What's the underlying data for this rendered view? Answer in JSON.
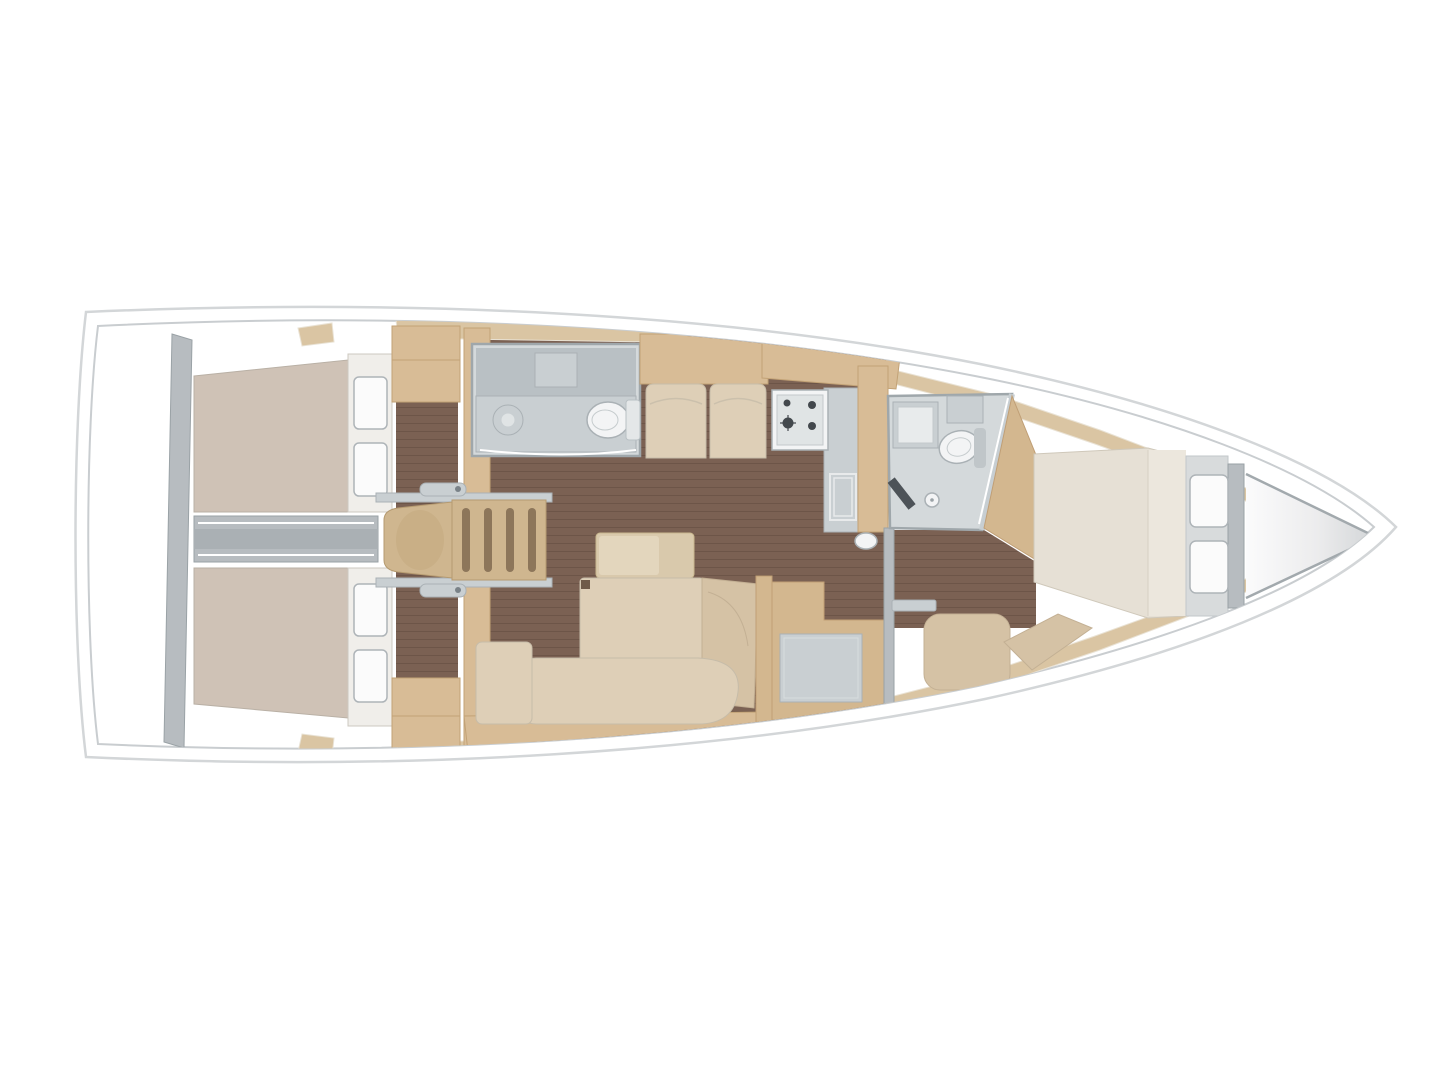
{
  "diagram": {
    "type": "sailboat-interior-floor-plan",
    "view": "top-down",
    "orientation": "bow-right",
    "features": [
      {
        "id": "hull-outline",
        "label": "sailboat hull with double deck line"
      },
      {
        "id": "transom-platform",
        "label": "stern platform"
      },
      {
        "id": "aft-cabin-port",
        "label": "aft double cabin port with berth and two pillows"
      },
      {
        "id": "aft-cabin-starboard",
        "label": "aft double cabin starboard with berth and two pillows"
      },
      {
        "id": "engine-box",
        "label": "engine compartment between aft cabins"
      },
      {
        "id": "companionway-stairs",
        "label": "companionway steps with four treads"
      },
      {
        "id": "head-aft",
        "label": "aft head with round washbasin and toilet"
      },
      {
        "id": "settee",
        "label": "two seat settee facing salon table"
      },
      {
        "id": "galley",
        "label": "galley with four burner stove, fridge and sink"
      },
      {
        "id": "salon",
        "label": "salon with table, chaise sofa and bench seat"
      },
      {
        "id": "nav-desk",
        "label": "chart table"
      },
      {
        "id": "head-forward",
        "label": "forward head with washbasin, toilet and shower drain"
      },
      {
        "id": "forward-cabin",
        "label": "forward cabin with island berth and two pillows"
      },
      {
        "id": "bow-locker",
        "label": "anchor locker in bow"
      }
    ]
  },
  "palette": {
    "page_bg": "#ffffff",
    "hull_fill": "#ffffff",
    "hull_stroke": "#d3d6d8",
    "inner_line": "#c9cdd0",
    "wall": "#b7bcc0",
    "wall_stroke": "#9aa2a6",
    "room": "#d4d9db",
    "room_dark": "#b9c0c4",
    "counter": "#c9cfd2",
    "fixture": "#f3f4f5",
    "fixture_stroke": "#aab1b5",
    "floor": "#7b6153",
    "floor_line": "#6d5548",
    "wood": "#d8bc96",
    "wood_dark": "#c2a276",
    "wood_deep": "#d3b78f",
    "band": "#dac5a3",
    "mattress": "#cfc2b6",
    "sheet": "#f0eeea",
    "pillow": "#fbfbfb",
    "cushion": "#decfb7",
    "cushion_dark": "#d5c2a5",
    "bed": "#e6e0d5",
    "bed_light": "#ece7dd",
    "table": "#d9c9ac",
    "table_light": "#e3d6bd",
    "stair": "#cfb68f",
    "slat": "#8d765a",
    "dark": "#43484d",
    "glass": "#c7ced2",
    "bow_start": "#fbfbfc",
    "bow_end": "#d2d5d7"
  }
}
